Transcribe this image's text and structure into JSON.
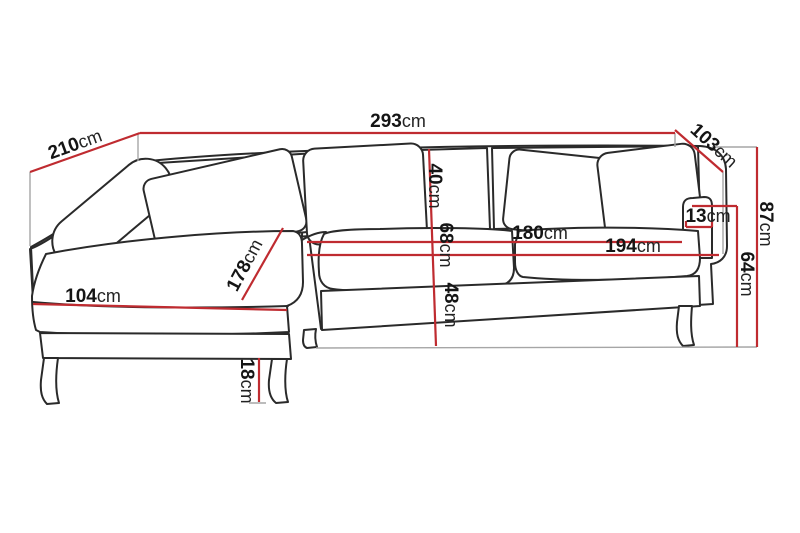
{
  "diagram": {
    "type": "furniture-dimension-diagram",
    "subject": "corner sofa with left chaise longue, line drawing with measurements",
    "unit": "cm",
    "colors": {
      "background": "#ffffff",
      "dimension_line": "#bf2b30",
      "sofa_outline": "#2a2a2a",
      "extension_line": "#a6a6a6",
      "label_text": "#151515"
    },
    "dimensions": [
      {
        "id": "width-top",
        "value": "293",
        "unit": "cm"
      },
      {
        "id": "depth-left-chaise",
        "value": "210",
        "unit": "cm"
      },
      {
        "id": "depth-right",
        "value": "103",
        "unit": "cm"
      },
      {
        "id": "height-total",
        "value": "87",
        "unit": "cm"
      },
      {
        "id": "armrest-top-width",
        "value": "13",
        "unit": "cm"
      },
      {
        "id": "armrest-height",
        "value": "64",
        "unit": "cm"
      },
      {
        "id": "back-cushion-height",
        "value": "40",
        "unit": "cm"
      },
      {
        "id": "seat-depth",
        "value": "68",
        "unit": "cm"
      },
      {
        "id": "seat-height",
        "value": "48",
        "unit": "cm"
      },
      {
        "id": "inner-seat-width",
        "value": "180",
        "unit": "cm"
      },
      {
        "id": "seat-width",
        "value": "194",
        "unit": "cm"
      },
      {
        "id": "chaise-length",
        "value": "178",
        "unit": "cm"
      },
      {
        "id": "chaise-front-width",
        "value": "104",
        "unit": "cm"
      },
      {
        "id": "leg-height",
        "value": "18",
        "unit": "cm"
      }
    ]
  }
}
